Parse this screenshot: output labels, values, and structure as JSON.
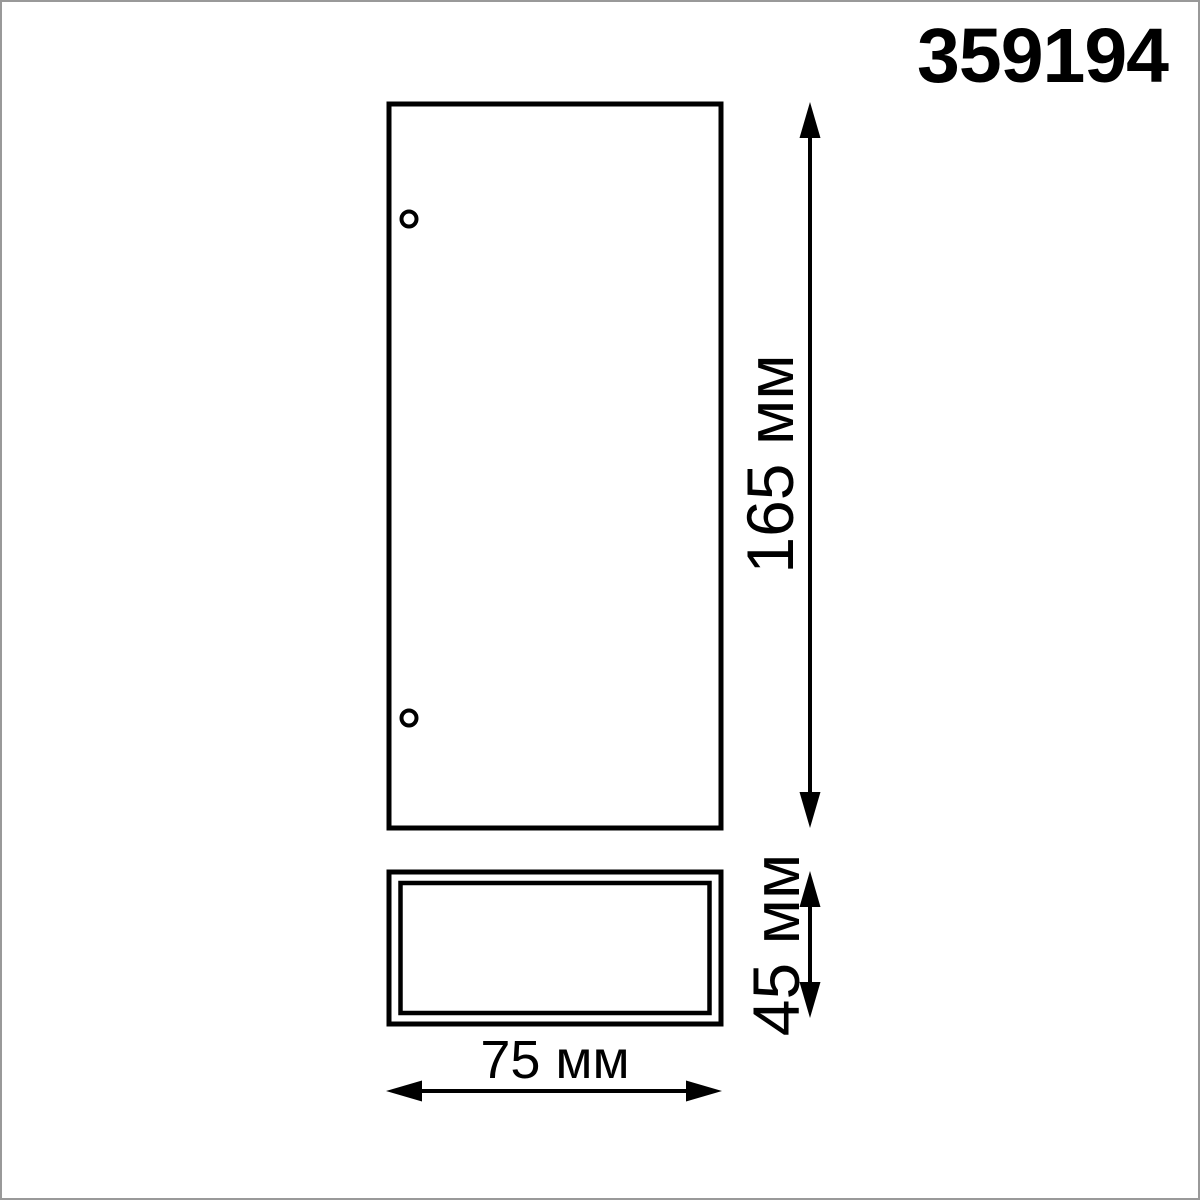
{
  "drawing": {
    "product_code": "359194",
    "dimensions": {
      "height_label": "165 мм",
      "depth_label": "45 мм",
      "width_label": "75 мм",
      "height_value_mm": 165,
      "depth_value_mm": 45,
      "width_value_mm": 75,
      "unit": "мм"
    },
    "views": {
      "front": "front view rectangle with two mounting holes",
      "side": "side profile rectangle with double outline"
    },
    "colors": {
      "line": "#000000",
      "background": "#ffffff",
      "page_border": "#999999"
    }
  }
}
